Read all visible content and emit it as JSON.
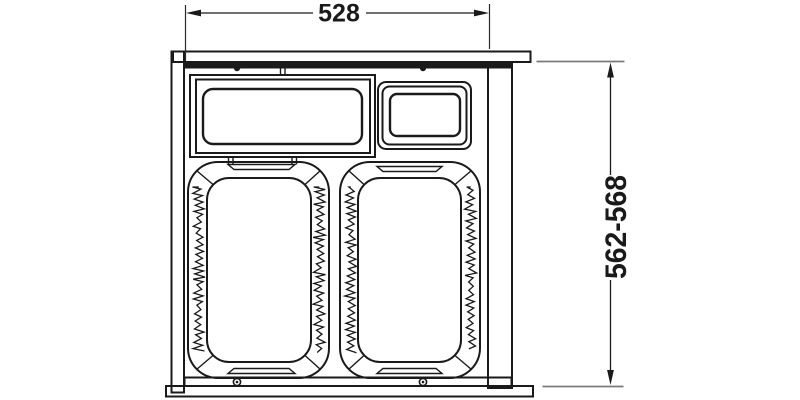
{
  "colors": {
    "line": "#1a1a1a",
    "dimension_extension_gray": "#7a7a7a",
    "background": "#ffffff"
  },
  "diagram": {
    "width_dimension": {
      "label": "528"
    },
    "depth_dimension": {
      "label": "562-568"
    }
  }
}
